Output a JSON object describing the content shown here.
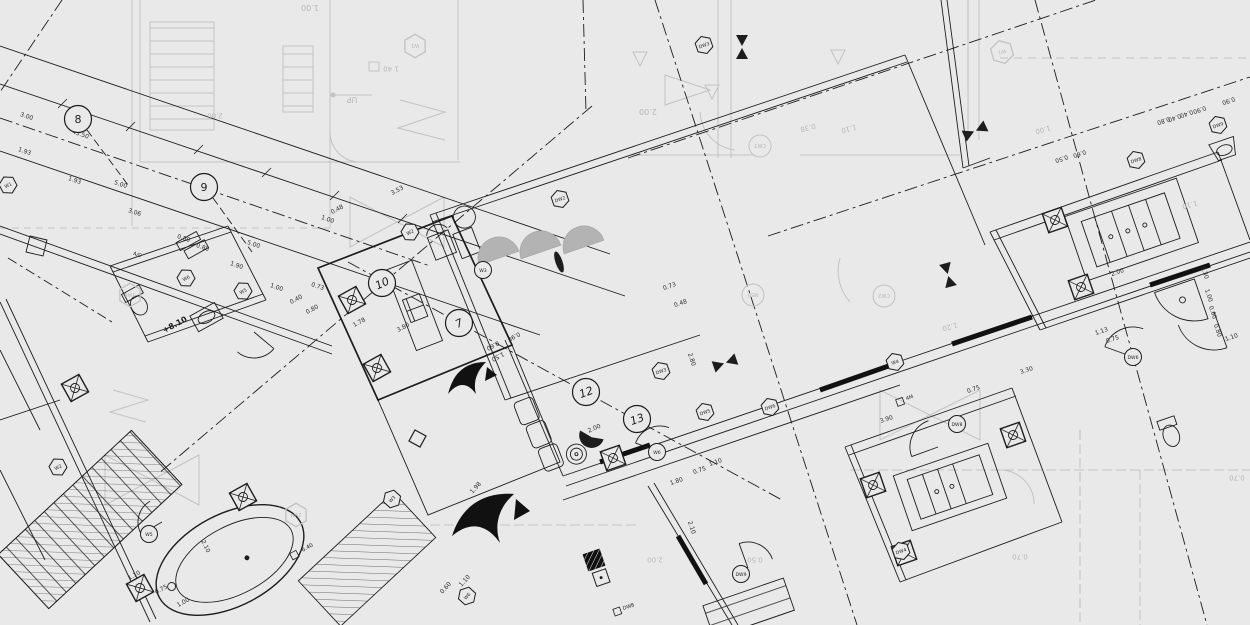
{
  "meta": {
    "type": "architectural-floor-plan-blueprint",
    "background_color": "#e9e9e9",
    "ink_color": "#1d1d1d",
    "underlay_color": "#c2c2c2",
    "awning_color": "#b3b3b3"
  },
  "plan_texts": [
    {
      "t": "+8.10",
      "x": 176,
      "y": 327,
      "a": -28,
      "s": 8
    },
    {
      "t": "A/C",
      "x": 137,
      "y": 256,
      "a": 19,
      "s": 5
    },
    {
      "t": "6.40",
      "x": 308,
      "y": 549,
      "a": -28,
      "s": 5.5,
      "box": true
    },
    {
      "t": "DW8",
      "x": 629,
      "y": 608,
      "a": -19,
      "s": 5,
      "box": true
    },
    {
      "t": "4M",
      "x": 910,
      "y": 399,
      "a": -19,
      "s": 5,
      "box": true
    }
  ],
  "grid_bubbles": [
    {
      "n": "8",
      "x": 78,
      "y": 119,
      "a": 0
    },
    {
      "n": "9",
      "x": 204,
      "y": 187,
      "a": 0
    },
    {
      "n": "10",
      "x": 382,
      "y": 283,
      "a": -25
    },
    {
      "n": "7",
      "x": 459,
      "y": 323,
      "a": -25
    },
    {
      "n": "12",
      "x": 586,
      "y": 392,
      "a": -20
    },
    {
      "n": "13",
      "x": 637,
      "y": 419,
      "a": -20
    }
  ],
  "hex_tags": [
    {
      "t": "W1",
      "x": 8,
      "y": 185,
      "a": -28
    },
    {
      "t": "W6",
      "x": 186,
      "y": 278,
      "a": -28
    },
    {
      "t": "W5",
      "x": 243,
      "y": 291,
      "a": -28
    },
    {
      "t": "W2",
      "x": 410,
      "y": 232,
      "a": -28
    },
    {
      "t": "DW2",
      "x": 560,
      "y": 199,
      "a": -19
    },
    {
      "t": "DW3",
      "x": 661,
      "y": 371,
      "a": -19
    },
    {
      "t": "W4",
      "x": 895,
      "y": 362,
      "a": -19
    },
    {
      "t": "DW5",
      "x": 705,
      "y": 412,
      "a": -19
    },
    {
      "t": "DW6",
      "x": 770,
      "y": 407,
      "a": -19
    },
    {
      "t": "DW8",
      "x": 1136,
      "y": 160,
      "a": -19
    },
    {
      "t": "DW9",
      "x": 1218,
      "y": 125,
      "a": -19
    },
    {
      "t": "DW4",
      "x": 901,
      "y": 551,
      "a": -19
    },
    {
      "t": "W3",
      "x": 392,
      "y": 499,
      "a": -48
    },
    {
      "t": "W6",
      "x": 467,
      "y": 596,
      "a": -48
    },
    {
      "t": "W2",
      "x": 58,
      "y": 467,
      "a": -28
    },
    {
      "t": "DW3",
      "x": 704,
      "y": 45,
      "a": -19
    }
  ],
  "circle_tags": [
    {
      "t": "W6",
      "x": 657,
      "y": 452
    },
    {
      "t": "DW8",
      "x": 957,
      "y": 424
    },
    {
      "t": "DW6",
      "x": 1133,
      "y": 357
    },
    {
      "t": "W5",
      "x": 149,
      "y": 534
    },
    {
      "t": "DW9",
      "x": 741,
      "y": 574
    },
    {
      "t": "W3",
      "x": 483,
      "y": 270
    }
  ],
  "dim_labels": [
    {
      "t": "3.00",
      "x": 26,
      "y": 118,
      "a": 19
    },
    {
      "t": "45.50",
      "x": 80,
      "y": 136,
      "a": 19
    },
    {
      "t": "1.93",
      "x": 24,
      "y": 153,
      "a": 19
    },
    {
      "t": "1.93",
      "x": 74,
      "y": 182,
      "a": 19
    },
    {
      "t": "5.00",
      "x": 120,
      "y": 186,
      "a": 19
    },
    {
      "t": "3.06",
      "x": 134,
      "y": 214,
      "a": 19
    },
    {
      "t": "0.80",
      "x": 183,
      "y": 240,
      "a": 19
    },
    {
      "t": "0.80",
      "x": 202,
      "y": 249,
      "a": 19
    },
    {
      "t": "1.90",
      "x": 236,
      "y": 267,
      "a": 19
    },
    {
      "t": "5.00",
      "x": 253,
      "y": 246,
      "a": 19
    },
    {
      "t": "1.00",
      "x": 327,
      "y": 221,
      "a": 19
    },
    {
      "t": "0.73",
      "x": 317,
      "y": 288,
      "a": 19
    },
    {
      "t": "1.00",
      "x": 276,
      "y": 289,
      "a": 19
    },
    {
      "t": "0.40",
      "x": 297,
      "y": 301,
      "a": -28
    },
    {
      "t": "0.80",
      "x": 313,
      "y": 311,
      "a": -28
    },
    {
      "t": "1.78",
      "x": 360,
      "y": 324,
      "a": -28
    },
    {
      "t": "3.53",
      "x": 398,
      "y": 192,
      "a": -28
    },
    {
      "t": "0.48",
      "x": 338,
      "y": 211,
      "a": -28
    },
    {
      "t": "3.80",
      "x": 404,
      "y": 329,
      "a": -28
    },
    {
      "t": "1.50",
      "x": 497,
      "y": 355,
      "a": 152
    },
    {
      "t": "0.60",
      "x": 492,
      "y": 344,
      "a": 152
    },
    {
      "t": "0.90",
      "x": 513,
      "y": 335,
      "a": 152
    },
    {
      "t": "2.00",
      "x": 595,
      "y": 430,
      "a": -24
    },
    {
      "t": "2.80",
      "x": 690,
      "y": 360,
      "a": 71
    },
    {
      "t": "0.73",
      "x": 670,
      "y": 288,
      "a": -19
    },
    {
      "t": "0.48",
      "x": 681,
      "y": 305,
      "a": -19
    },
    {
      "t": "1.10",
      "x": 716,
      "y": 464,
      "a": -19
    },
    {
      "t": "0.75",
      "x": 700,
      "y": 472,
      "a": -19
    },
    {
      "t": "1.80",
      "x": 677,
      "y": 483,
      "a": -19
    },
    {
      "t": "2.10",
      "x": 690,
      "y": 528,
      "a": 71
    },
    {
      "t": "2.10",
      "x": 204,
      "y": 547,
      "a": 64
    },
    {
      "t": "1.10",
      "x": 135,
      "y": 577,
      "a": -28
    },
    {
      "t": "0.75",
      "x": 162,
      "y": 591,
      "a": -28
    },
    {
      "t": "1.00",
      "x": 184,
      "y": 604,
      "a": -28
    },
    {
      "t": "0.60",
      "x": 447,
      "y": 589,
      "a": -48
    },
    {
      "t": "1.10",
      "x": 466,
      "y": 582,
      "a": -48
    },
    {
      "t": "1.98",
      "x": 477,
      "y": 489,
      "a": -48
    },
    {
      "t": "3.90",
      "x": 887,
      "y": 421,
      "a": -19
    },
    {
      "t": "3.30",
      "x": 1027,
      "y": 372,
      "a": -19
    },
    {
      "t": "0.75",
      "x": 974,
      "y": 391,
      "a": -19
    },
    {
      "t": "2.00",
      "x": 1118,
      "y": 274,
      "a": -19
    },
    {
      "t": "1.13",
      "x": 1102,
      "y": 333,
      "a": -19
    },
    {
      "t": "0.75",
      "x": 1113,
      "y": 341,
      "a": -19
    },
    {
      "t": "1.10",
      "x": 1232,
      "y": 339,
      "a": -19
    },
    {
      "t": "0.30",
      "x": 1203,
      "y": 273,
      "a": 71
    },
    {
      "t": "1.00",
      "x": 1207,
      "y": 296,
      "a": 71
    },
    {
      "t": "0.60",
      "x": 1211,
      "y": 313,
      "a": 71
    },
    {
      "t": "0.80",
      "x": 1216,
      "y": 331,
      "a": 71
    },
    {
      "t": "0.40",
      "x": 1174,
      "y": 116,
      "a": 161
    },
    {
      "t": "0.40",
      "x": 1186,
      "y": 112,
      "a": 161
    },
    {
      "t": "0.80",
      "x": 1163,
      "y": 119,
      "a": 161
    },
    {
      "t": "0.90",
      "x": 1199,
      "y": 108,
      "a": 161
    },
    {
      "t": "0.90",
      "x": 1228,
      "y": 99,
      "a": 161
    },
    {
      "t": "0.50",
      "x": 1061,
      "y": 157,
      "a": 161
    },
    {
      "t": "0.60",
      "x": 1079,
      "y": 152,
      "a": 161
    }
  ],
  "underlay_texts": [
    {
      "t": "1.00",
      "x": 310,
      "y": 8,
      "a": 180,
      "s": 8
    },
    {
      "t": "2.00",
      "x": 215,
      "y": 116,
      "a": 180,
      "s": 7
    },
    {
      "t": "2.00",
      "x": 648,
      "y": 112,
      "a": 180,
      "s": 8
    },
    {
      "t": "1 40",
      "x": 391,
      "y": 69,
      "a": 180,
      "s": 7
    },
    {
      "t": "UP",
      "x": 352,
      "y": 100,
      "a": 180,
      "s": 8
    },
    {
      "t": "0.38",
      "x": 808,
      "y": 128,
      "a": 165,
      "s": 7
    },
    {
      "t": "1.10",
      "x": 849,
      "y": 129,
      "a": 165,
      "s": 7
    },
    {
      "t": "1.00",
      "x": 1043,
      "y": 130,
      "a": 165,
      "s": 7
    },
    {
      "t": "1.20",
      "x": 950,
      "y": 327,
      "a": 165,
      "s": 7
    },
    {
      "t": "1.10",
      "x": 1190,
      "y": 205,
      "a": 165,
      "s": 7
    },
    {
      "t": "2.00",
      "x": 655,
      "y": 560,
      "a": 180,
      "s": 7
    },
    {
      "t": "0.50",
      "x": 755,
      "y": 560,
      "a": 180,
      "s": 7
    },
    {
      "t": "0.70",
      "x": 1020,
      "y": 557,
      "a": 180,
      "s": 7
    },
    {
      "t": "0.70",
      "x": 1237,
      "y": 478,
      "a": 180,
      "s": 7
    },
    {
      "t": "CW3",
      "x": 760,
      "y": 146,
      "a": 180,
      "s": 5,
      "kind": "circle"
    },
    {
      "t": "CW2",
      "x": 884,
      "y": 296,
      "a": 180,
      "s": 5,
      "kind": "circle"
    },
    {
      "t": "M5B",
      "x": 753,
      "y": 295,
      "a": 180,
      "s": 5,
      "kind": "circle"
    },
    {
      "t": "W1",
      "x": 415,
      "y": 46,
      "a": 180,
      "s": 5,
      "kind": "hex"
    },
    {
      "t": "W1",
      "x": 1002,
      "y": 52,
      "a": 165,
      "s": 5,
      "kind": "hex"
    },
    {
      "t": "2VM",
      "x": 296,
      "y": 515,
      "a": 180,
      "s": 5,
      "kind": "hex"
    },
    {
      "t": "3W6",
      "x": 130,
      "y": 295,
      "a": 180,
      "s": 5,
      "kind": "hex"
    }
  ],
  "columns": [
    {
      "x": 75,
      "y": 388,
      "a": -29
    },
    {
      "x": 140,
      "y": 588,
      "a": -29
    },
    {
      "x": 243,
      "y": 497,
      "a": -29
    },
    {
      "x": 352,
      "y": 300,
      "a": -29
    },
    {
      "x": 377,
      "y": 368,
      "a": -29
    },
    {
      "x": 613,
      "y": 458,
      "a": -19
    },
    {
      "x": 873,
      "y": 485,
      "a": -19
    },
    {
      "x": 904,
      "y": 553,
      "a": -19
    },
    {
      "x": 1055,
      "y": 220,
      "a": -19
    },
    {
      "x": 1081,
      "y": 287,
      "a": -19
    },
    {
      "x": 1013,
      "y": 435,
      "a": -19
    },
    {
      "x": 594,
      "y": 560,
      "a": -19,
      "filled": true
    }
  ],
  "window_symbols": [
    {
      "x": 742,
      "y": 47,
      "a": 90
    },
    {
      "x": 948,
      "y": 275,
      "a": 75
    },
    {
      "x": 725,
      "y": 363,
      "a": -19
    },
    {
      "x": 975,
      "y": 131,
      "a": -25
    }
  ],
  "door_arcs": [
    {
      "x": 660,
      "y": 452,
      "r": 26,
      "a0": 200,
      "a1": 290
    },
    {
      "x": 938,
      "y": 447,
      "r": 28,
      "a0": 160,
      "a1": 250
    },
    {
      "x": 1133,
      "y": 357,
      "r": 30,
      "a0": 200,
      "a1": 290
    },
    {
      "x": 162,
      "y": 522,
      "r": 24,
      "a0": 150,
      "a1": 240
    },
    {
      "x": 748,
      "y": 568,
      "r": 26,
      "a0": 250,
      "a1": 340
    },
    {
      "x": 254,
      "y": 332,
      "r": 26,
      "a0": 40,
      "a1": 130
    },
    {
      "x": 1214,
      "y": 312,
      "r": 38,
      "a0": 70,
      "a1": 160
    }
  ],
  "awnings": [
    {
      "x": 499,
      "y": 258,
      "r": 21,
      "a": -19
    },
    {
      "x": 541,
      "y": 252,
      "r": 21,
      "a": -19
    },
    {
      "x": 584,
      "y": 247,
      "r": 21,
      "a": -19
    }
  ]
}
